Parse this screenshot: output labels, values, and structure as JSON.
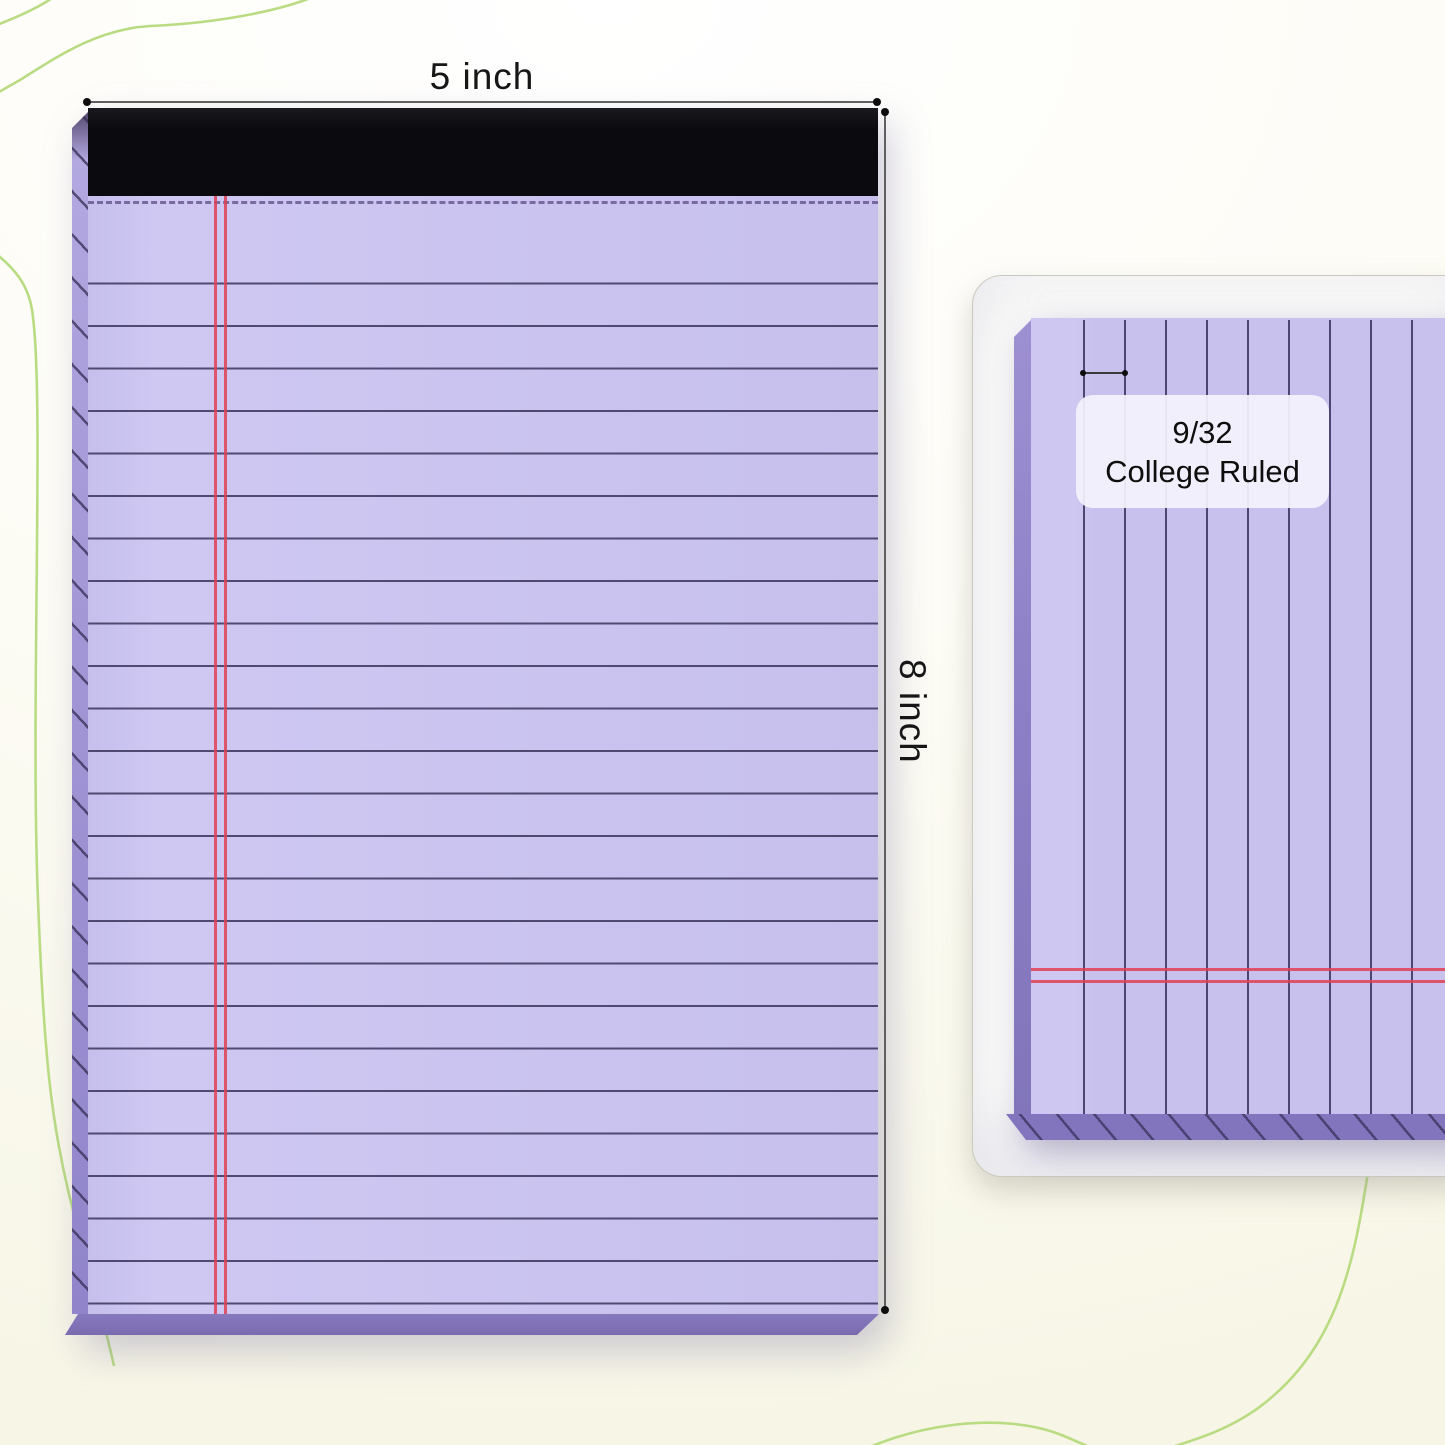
{
  "front_view": {
    "width_label": "5 inch",
    "height_label": "8 inch"
  },
  "detail_view": {
    "ruling_fraction": "9/32",
    "ruling_name": "College Ruled"
  },
  "style": {
    "paper_color": "#cac3ef",
    "rule_line_color": "#45406a",
    "margin_line_color": "#e04054",
    "binding_color": "#0b0a0e",
    "pad_side_color": "#9b8ed3",
    "pad_bottom_edge_color": "#7d6eb5",
    "background_color": "#f9f8ec",
    "accent_curve_color": "#b9dc83",
    "dimension_line_color": "#5f5f5f",
    "text_color": "#161616"
  }
}
